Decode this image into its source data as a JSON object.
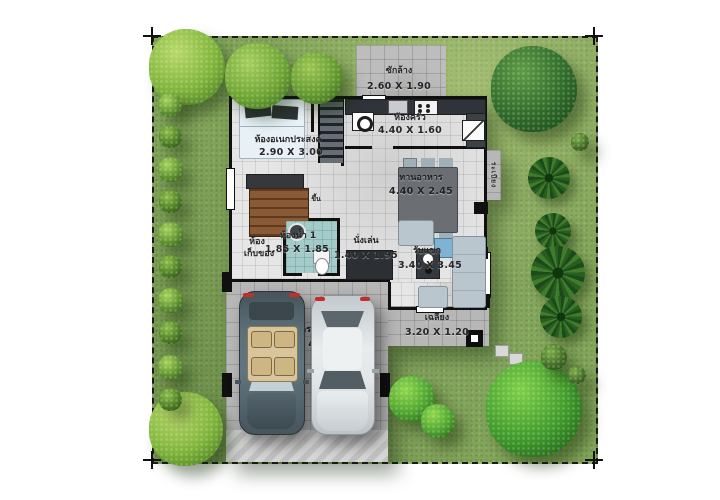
{
  "rooms": {
    "laundry": {
      "name": "ซักล้าง",
      "dims": "2.60 X 1.90"
    },
    "multipurpose": {
      "name": "ห้องอเนกประสงค์",
      "dims": "2.90 X 3.00"
    },
    "kitchen": {
      "name": "ห้องครัว",
      "dims": "4.40 X 1.60"
    },
    "dining": {
      "name": "ทานอาหาร",
      "dims": "4.40 X 2.45"
    },
    "bathroom": {
      "name": "ห้องน้ำ 1",
      "dims": "1.85 X 1.85"
    },
    "storage": {
      "line1": "ห้อง",
      "line2": "เก็บของ"
    },
    "sitting": {
      "name": "นั่งเล่น",
      "dims": "1.40 X 1.95"
    },
    "living": {
      "name": "รับแขก",
      "dims": "3.40 X 3.45"
    },
    "porch": {
      "name": "เฉลียง",
      "dims": "3.20 X 1.20"
    },
    "carport": {
      "name": "จอดรถ",
      "dims": "5.10 X 4.40"
    },
    "stairs": {
      "label": "ขึ้น"
    },
    "balcony": {
      "label": "ระเบียง"
    }
  },
  "colors": {
    "lawn": "#84a55b",
    "wall": "#101010",
    "floor_tile": "#e6e6e6",
    "paving": "#b7b7b7",
    "bath_tile": "#a3cbc9",
    "stair_wood": "#8a5a36",
    "sofa": "#b9c6cd",
    "car_left": "#5c6e77",
    "car_right": "#d9dde0",
    "tree_dark": "#2f6b2a",
    "tree_light": "#7fb43c",
    "taillight_red": "#c03028"
  }
}
